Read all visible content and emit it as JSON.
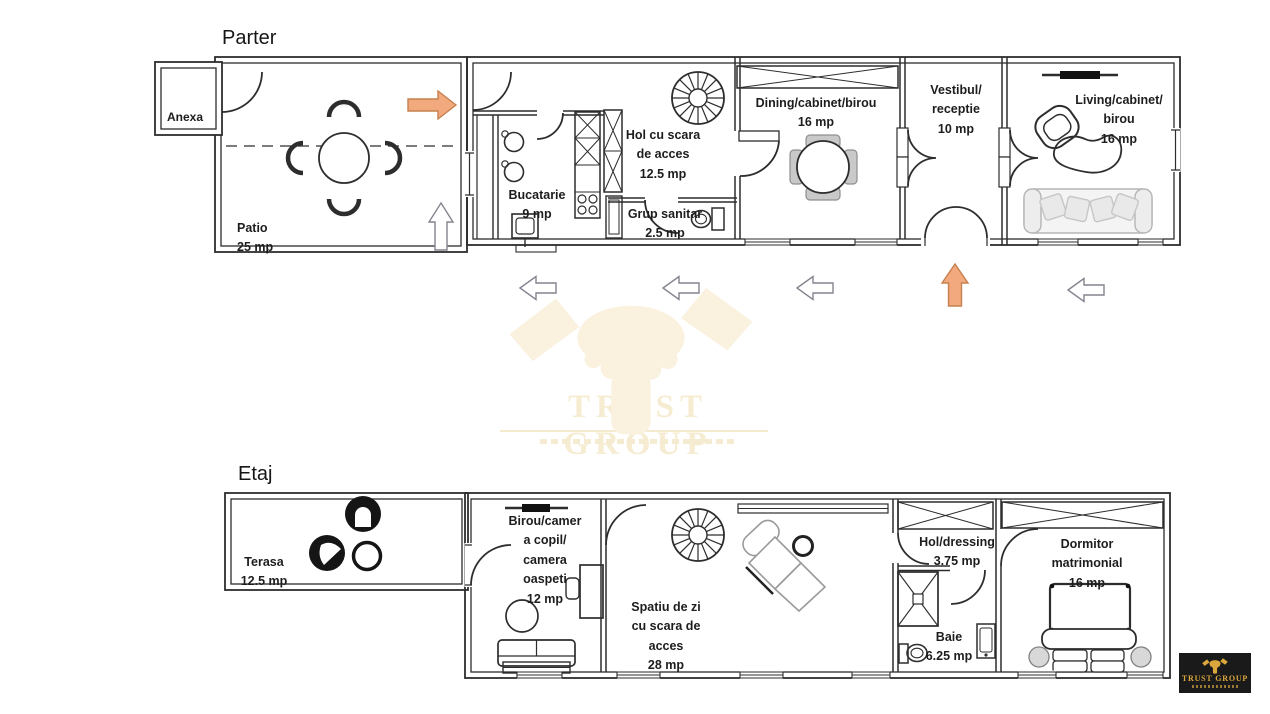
{
  "floors": {
    "parter": {
      "title": "Parter",
      "rooms": {
        "anexa": {
          "label": "Anexa"
        },
        "patio": {
          "label": "Patio\n25 mp"
        },
        "bucatarie": {
          "label": "Bucatarie\n9 mp"
        },
        "hol_scara": {
          "label": "Hol cu scara\nde acces\n12.5 mp"
        },
        "grup_sanitar": {
          "label": "Grup sanitar\n2.5 mp"
        },
        "dining": {
          "label": "Dining/cabinet/birou\n16 mp"
        },
        "vestibul": {
          "label": "Vestibul/\nreceptie\n10 mp"
        },
        "living": {
          "label": "Living/cabinet/\nbirou\n16 mp"
        }
      },
      "arrows_inside": [
        "right",
        "up"
      ]
    },
    "etaj": {
      "title": "Etaj",
      "rooms": {
        "terasa": {
          "label": "Terasa\n12.5 mp"
        },
        "birou_camera": {
          "label": "Birou/camer\na copil/\ncamera\noaspeti\n12 mp"
        },
        "spatiu_zi": {
          "label": "Spatiu de zi\ncu scara de\nacces\n28 mp"
        },
        "hol_dressing": {
          "label": "Hol/dressing\n3.75 mp"
        },
        "baie": {
          "label": "Baie\n6.25 mp"
        },
        "dormitor": {
          "label": "Dormitor\nmatrimonial\n16 mp"
        }
      }
    }
  },
  "arrows_between_floors": [
    "left",
    "left",
    "left",
    "up",
    "left"
  ],
  "watermark": {
    "brand": "TRUST GROUP"
  },
  "logo": {
    "brand": "TRUST GROUP"
  },
  "colors": {
    "wall_line": "#2d2d2d",
    "arrow_orange": "#f2a97e",
    "arrow_orange_border": "#c5814f",
    "arrow_outline_border": "#84848f",
    "watermark_cream": "#faf2df",
    "watermark_text": "#f6ecd2",
    "logo_gold": "#d9a73c",
    "logo_background": "#1a1a1a"
  }
}
